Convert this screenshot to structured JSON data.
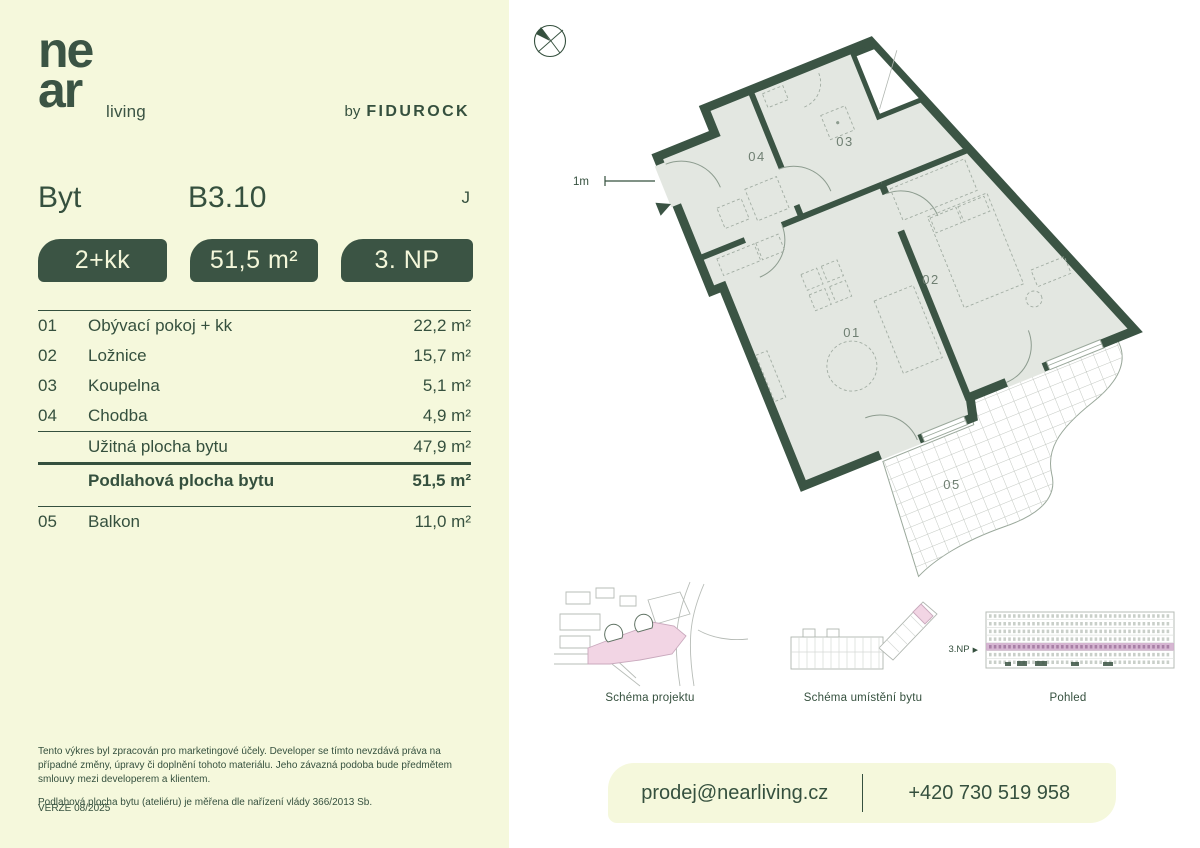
{
  "brand": {
    "logo_top": "ne",
    "logo_bottom": "ar",
    "logo_suffix": "living",
    "by_prefix": "by",
    "by_name": "FIDUROCK"
  },
  "header": {
    "type_label": "Byt",
    "unit_code": "B3.10",
    "orientation": "J"
  },
  "badges": {
    "layout": "2+kk",
    "area": "51,5 m²",
    "floor": "3. NP"
  },
  "table": {
    "rows": [
      {
        "num": "01",
        "name": "Obývací pokoj + kk",
        "area": "22,2 m²"
      },
      {
        "num": "02",
        "name": "Ložnice",
        "area": "15,7 m²"
      },
      {
        "num": "03",
        "name": "Koupelna",
        "area": "5,1 m²"
      },
      {
        "num": "04",
        "name": "Chodba",
        "area": "4,9 m²"
      }
    ],
    "usable": {
      "name": "Užitná plocha bytu",
      "area": "47,9 m²"
    },
    "total": {
      "name": "Podlahová plocha bytu",
      "area": "51,5 m²"
    },
    "balcony": {
      "num": "05",
      "name": "Balkon",
      "area": "11,0 m²"
    }
  },
  "disclaimer": {
    "p1": "Tento výkres byl zpracován pro marketingové účely. Developer se tímto nevzdává práva na případné změny, úpravy či doplnění tohoto materiálu. Jeho závazná podoba bude předmětem smlouvy mezi developerem a klientem.",
    "p2": "Podlahová plocha bytu (ateliéru) je měřena dle nařízení vlády 366/2013 Sb.",
    "version": "VERZE 08/2025"
  },
  "plan": {
    "scale_label": "1m",
    "labels": {
      "hall": "04",
      "bath": "03",
      "living": "01",
      "bedroom": "02",
      "balcony": "05"
    }
  },
  "schematics": {
    "project": "Schéma projektu",
    "unit_location": "Schéma umístění bytu",
    "elevation": "Pohled",
    "floor_marker": "3.NP",
    "marker_arrow": "▶"
  },
  "contact": {
    "email": "prodej@nearliving.cz",
    "phone": "+420 730 519 958"
  },
  "colors": {
    "accent_green": "#3b5444",
    "pale_yellow": "#f5f8dc",
    "floor_fill": "#e3e7e1",
    "highlight_pink": "#f2d5e4",
    "elevation_band": "#cfa9ca"
  }
}
